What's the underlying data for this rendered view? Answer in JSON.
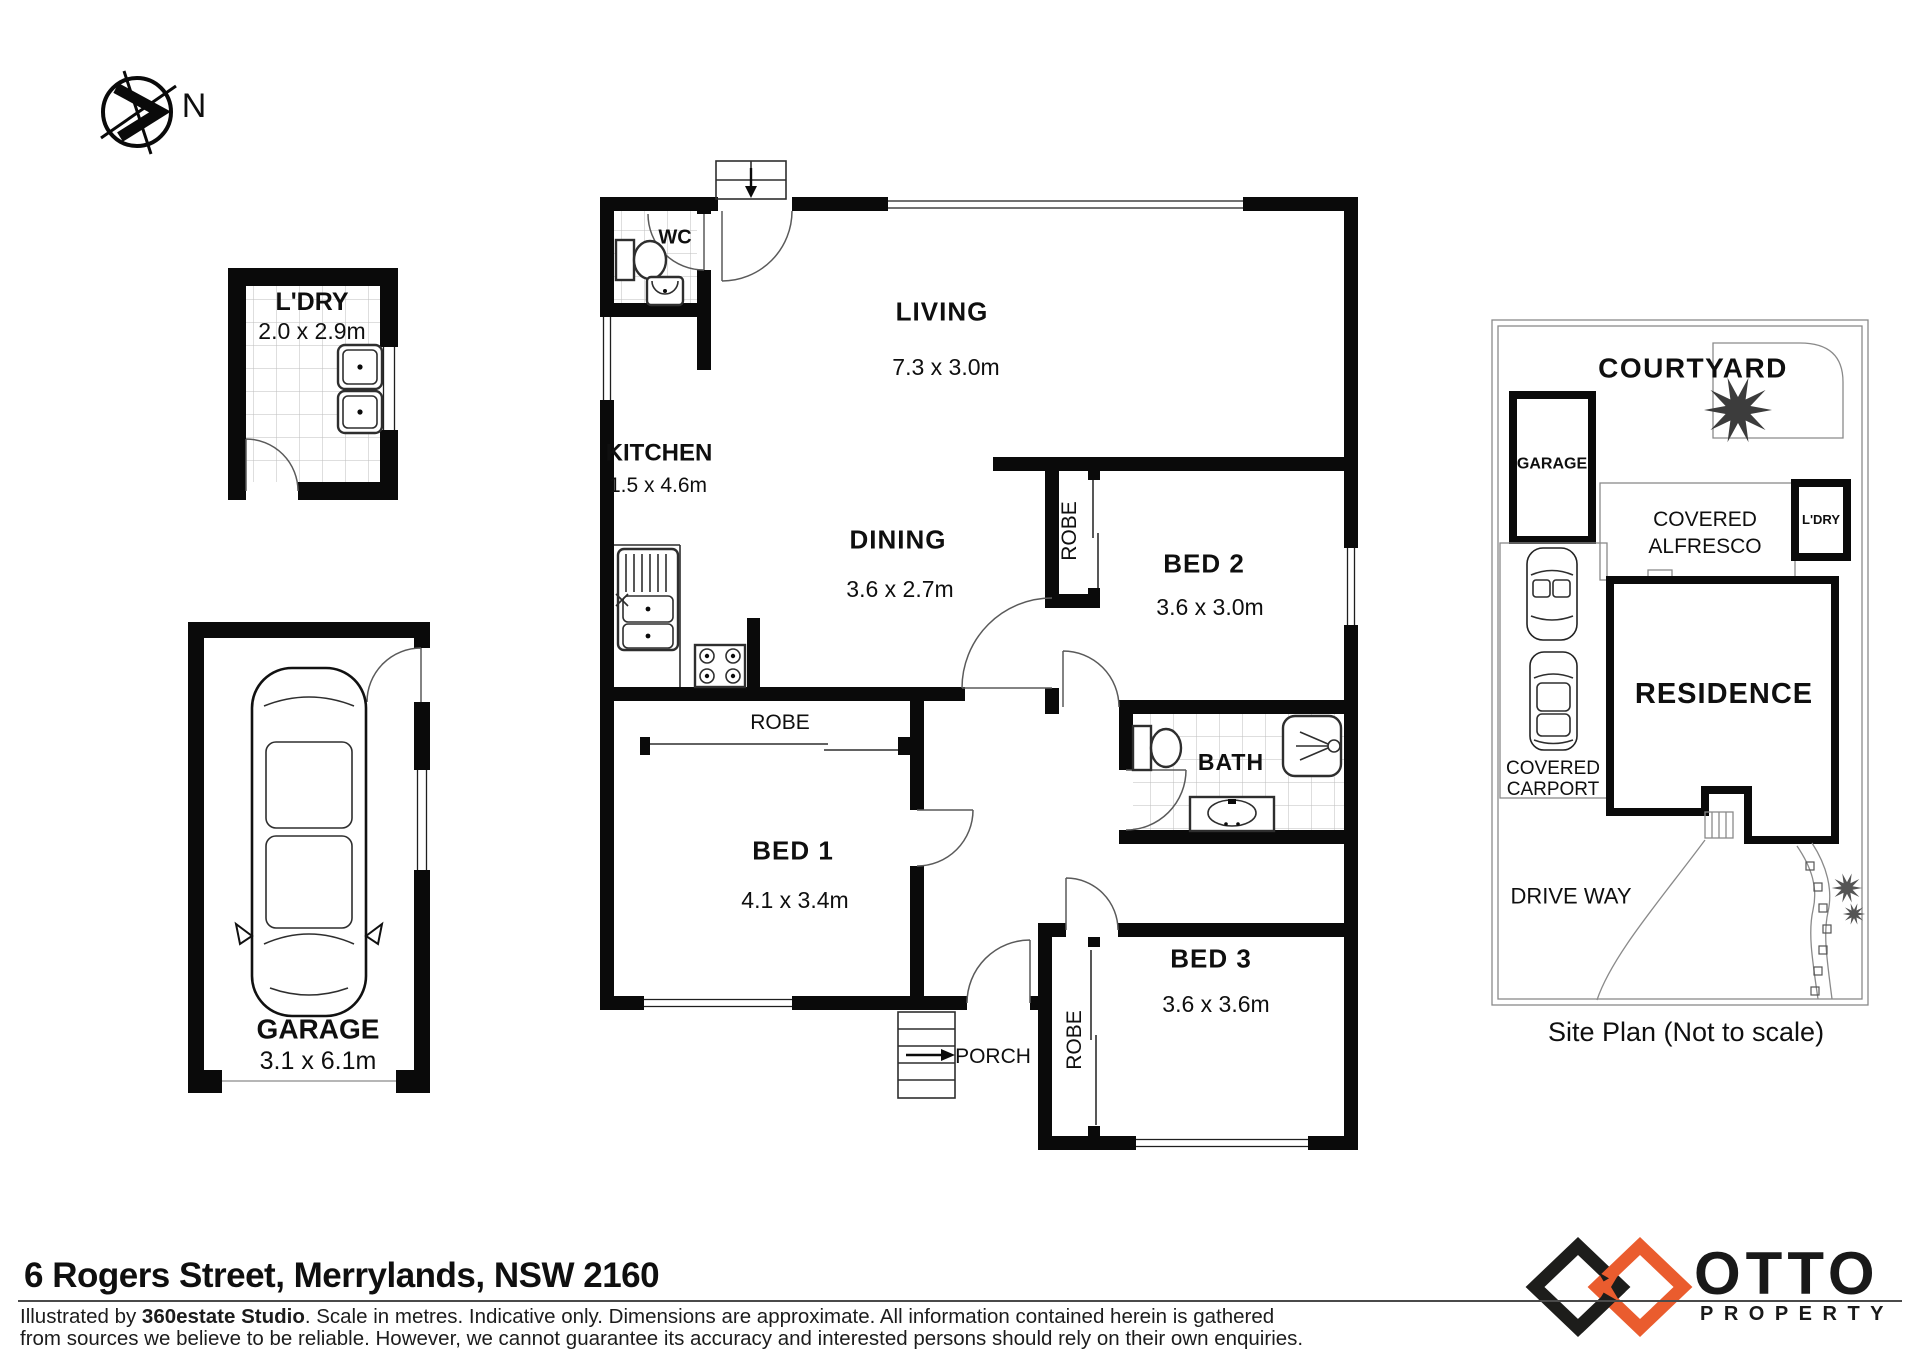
{
  "page": {
    "background": "#ffffff"
  },
  "colors": {
    "walls": "#0A0A0A",
    "accent": "#EA5C2E"
  },
  "icons": {
    "compass": "north-arrow-compass",
    "car": "car-top-view",
    "tree": "tree-foliage",
    "toilet": "toilet",
    "sink": "sink-basin",
    "shower": "shower-head",
    "stove": "four-burner-stove"
  },
  "compass": {
    "label": "N"
  },
  "floorplan": {
    "rooms": {
      "ldry": {
        "name": "L'DRY",
        "dims": "2.0 x 2.9m"
      },
      "garage": {
        "name": "GARAGE",
        "dims": "3.1 x 6.1m"
      },
      "wc": {
        "name": "WC"
      },
      "living": {
        "name": "LIVING",
        "dims": "7.3 x 3.0m"
      },
      "kitchen": {
        "name": "KITCHEN",
        "dims": "1.5 x 4.6m"
      },
      "dining": {
        "name": "DINING",
        "dims": "3.6 x 2.7m"
      },
      "bed1": {
        "name": "BED 1",
        "dims": "4.1 x 3.4m"
      },
      "bed2": {
        "name": "BED 2",
        "dims": "3.6 x 3.0m"
      },
      "bed3": {
        "name": "BED 3",
        "dims": "3.6 x 3.6m"
      },
      "bath": {
        "name": "BATH"
      },
      "porch": {
        "name": "PORCH"
      },
      "robe": {
        "name": "ROBE"
      }
    }
  },
  "siteplan": {
    "courtyard": "COURTYARD",
    "garage": "GARAGE",
    "alfresco_line1": "COVERED",
    "alfresco_line2": "ALFRESCO",
    "ldry": "L'DRY",
    "residence": "RESIDENCE",
    "carport_line1": "COVERED",
    "carport_line2": "CARPORT",
    "driveway": "DRIVE WAY",
    "caption": "Site Plan (Not to scale)"
  },
  "footer": {
    "address": "6 Rogers Street, Merrylands, NSW 2160",
    "disclaimer_prefix": "Illustrated by ",
    "disclaimer_studio": "360estate Studio",
    "disclaimer_line1_rest": ". Scale in metres. Indicative only. Dimensions are approximate. All information contained herein is gathered",
    "disclaimer_line2": "from sources we believe to be reliable. However, we cannot guarantee its accuracy and interested persons should rely on their own enquiries."
  },
  "logo": {
    "name": "OTTO",
    "subtitle": "PROPERTY"
  }
}
